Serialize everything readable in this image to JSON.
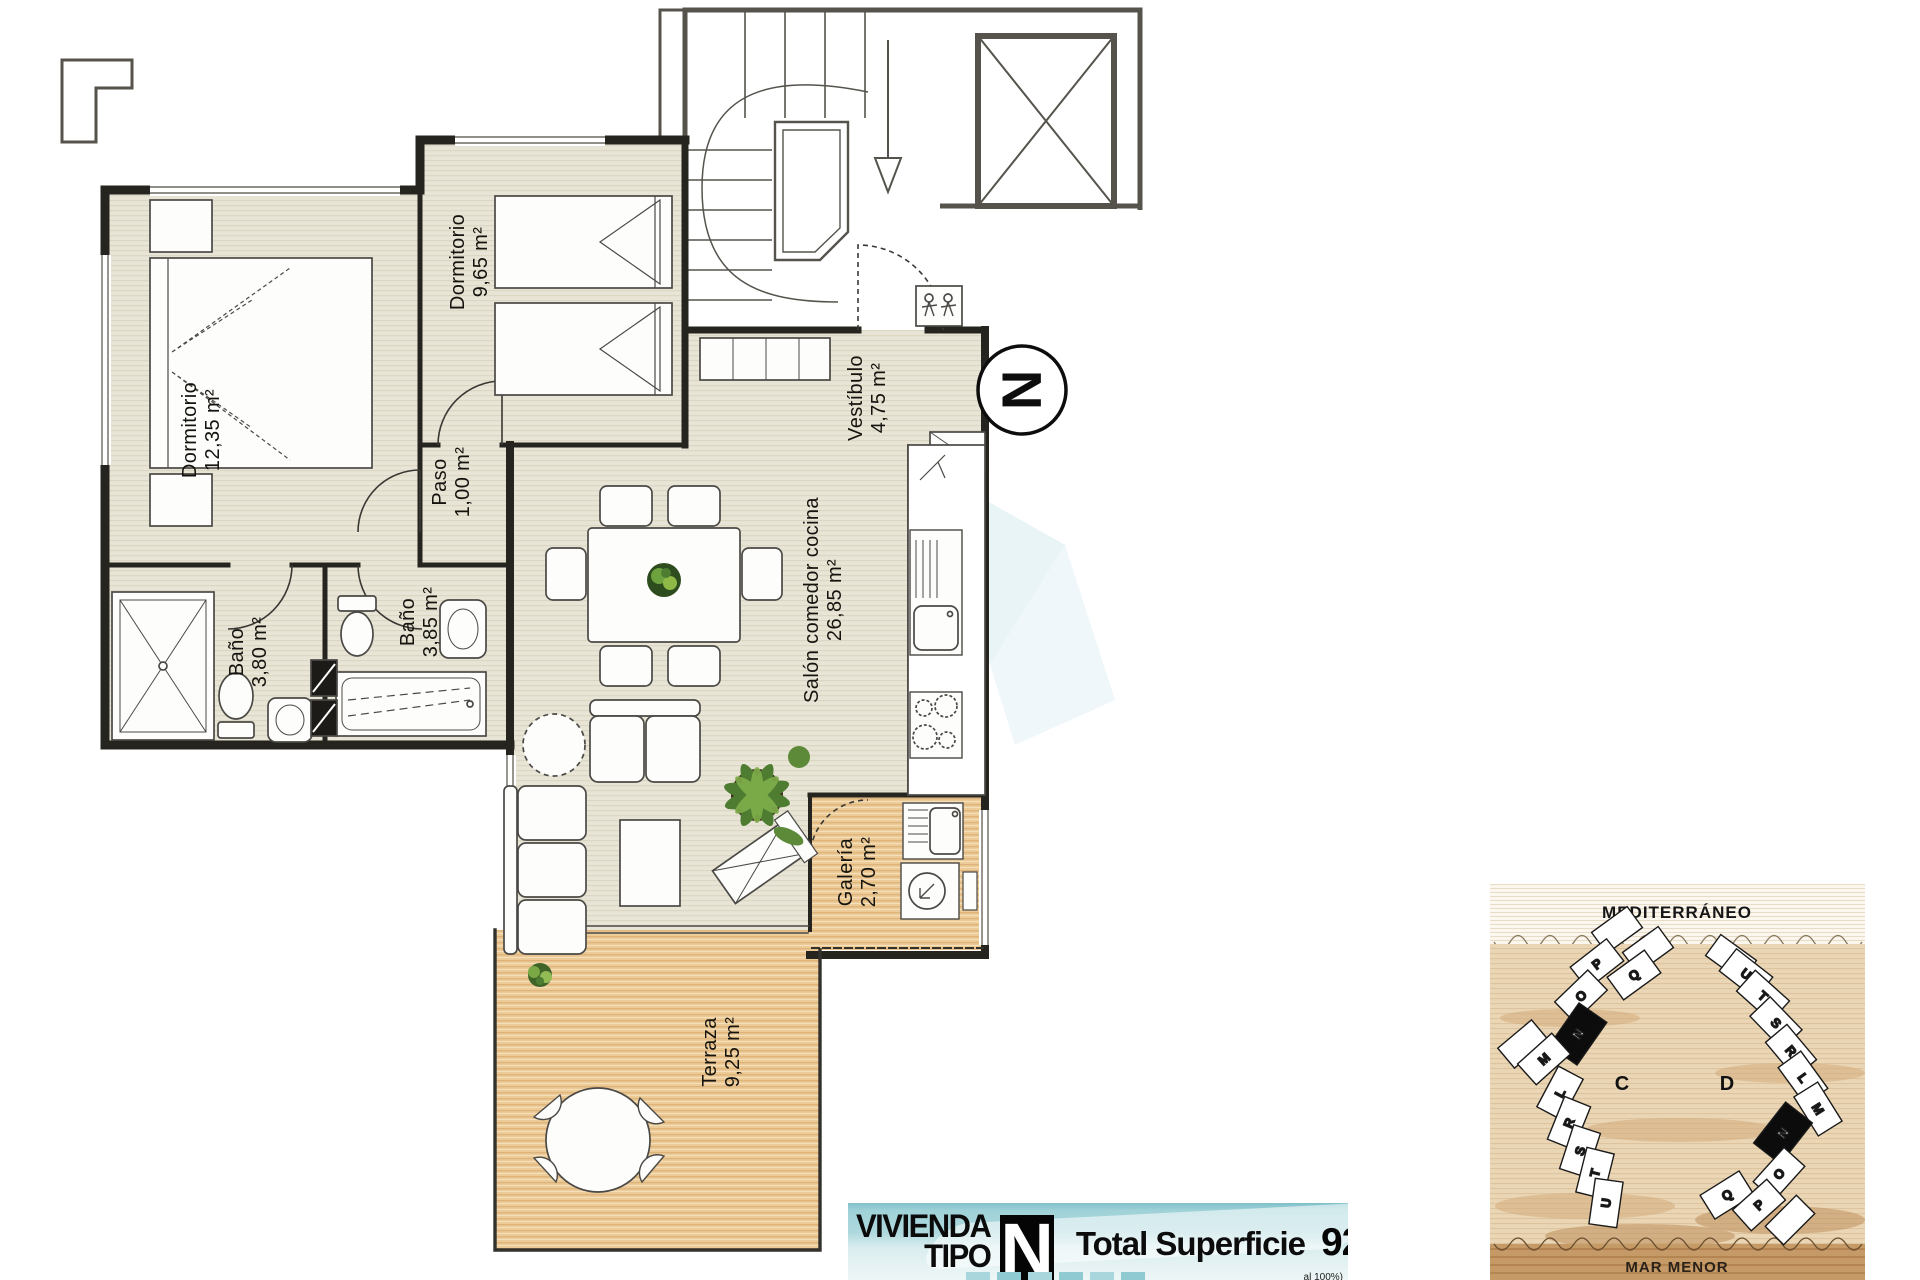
{
  "banner": {
    "label_line1": "VIVIENDA",
    "label_line2": "TIPO",
    "type_letter": "N",
    "total_label": "Total Superficie",
    "total_value": "92,43 m²",
    "footnote_fragment": "al 100%)",
    "accent_color": "#9fd2d8"
  },
  "north": {
    "letter": "N"
  },
  "plan": {
    "rooms": [
      {
        "name": "Dormitorio",
        "area": "12,35 m²"
      },
      {
        "name": "Dormitorio",
        "area": "9,65 m²"
      },
      {
        "name": "Paso",
        "area": "1,00 m²"
      },
      {
        "name": "Baño",
        "area": "3,80 m²"
      },
      {
        "name": "Baño",
        "area": "3,85 m²"
      },
      {
        "name": "Salón comedor cocina",
        "area": "26,85 m²"
      },
      {
        "name": "Vestíbulo",
        "area": "4,75 m²"
      },
      {
        "name": "Galería",
        "area": "2,70 m²"
      },
      {
        "name": "Terraza",
        "area": "9,25 m²"
      }
    ],
    "colors": {
      "floor": "#e8e5d7",
      "wood": "#eccb97",
      "wall": "#26241f"
    }
  },
  "sitemap": {
    "sea_top": "MEDITERRÁNEO",
    "sea_bottom": "MAR MENOR",
    "clusters": [
      {
        "label": "C",
        "highlight": "N",
        "buildings": [
          "P",
          "Q",
          "O",
          "N",
          "M",
          "L",
          "R",
          "S",
          "T",
          "U"
        ]
      },
      {
        "label": "D",
        "highlight": "N",
        "buildings": [
          "U",
          "T",
          "S",
          "R",
          "L",
          "M",
          "N",
          "O",
          "Q",
          "P"
        ]
      }
    ]
  }
}
